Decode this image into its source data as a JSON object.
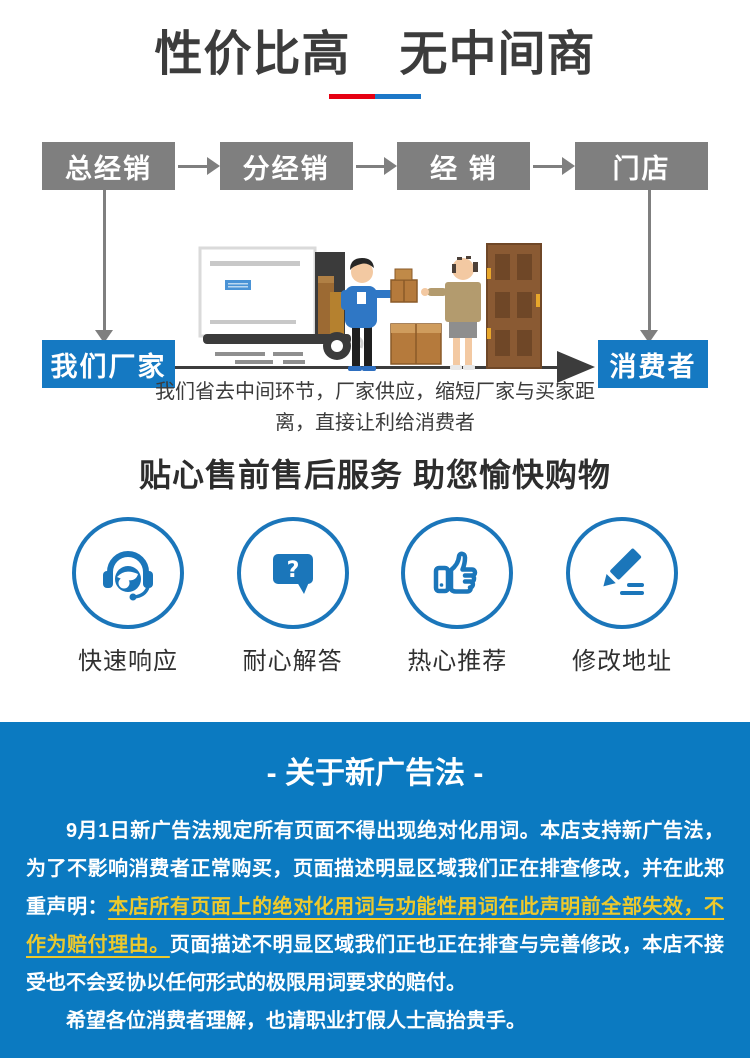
{
  "header": {
    "title": "性价比高　无中间商",
    "divider_colors": {
      "red": "#e60012",
      "blue": "#1d78c8"
    }
  },
  "flow": {
    "chain": [
      "总经销",
      "分经销",
      "经 销",
      "门店"
    ],
    "factory_label": "我们厂家",
    "consumer_label": "消费者",
    "caption": "我们省去中间环节，厂家供应，缩短厂家与买家距离，直接让利给消费者",
    "box_gray": "#7f7f7f",
    "box_blue": "#1579c2",
    "arrow_dark": "#3c3c3c"
  },
  "services": {
    "title": "贴心售前售后服务 助您愉快购物",
    "accent_color": "#1b76ba",
    "items": [
      {
        "label": "快速响应",
        "icon": "headset-icon"
      },
      {
        "label": "耐心解答",
        "icon": "question-bubble-icon",
        "bubble_char": "?"
      },
      {
        "label": "热心推荐",
        "icon": "thumbs-up-icon"
      },
      {
        "label": "修改地址",
        "icon": "edit-pencil-icon"
      }
    ]
  },
  "notice": {
    "title": "- 关于新广告法 -",
    "background_color": "#0b7ac1",
    "highlight_color": "#edc92c",
    "paragraph1_part1": "9月1日新广告法规定所有页面不得出现绝对化用词。本店支持新广告法，为了不影响消费者正常购买，页面描述明显区域我们正在排查修改，并在此郑重声明：",
    "paragraph1_highlight": "本店所有页面上的绝对化用词与功能性用词在此声明前全部失效，不作为赔付理由。",
    "paragraph1_part2": "页面描述不明显区域我们正也正在排查与完善修改，本店不接受也不会妥协以任何形式的极限用词要求的赔付。",
    "paragraph2": "希望各位消费者理解，也请职业打假人士高抬贵手。"
  }
}
